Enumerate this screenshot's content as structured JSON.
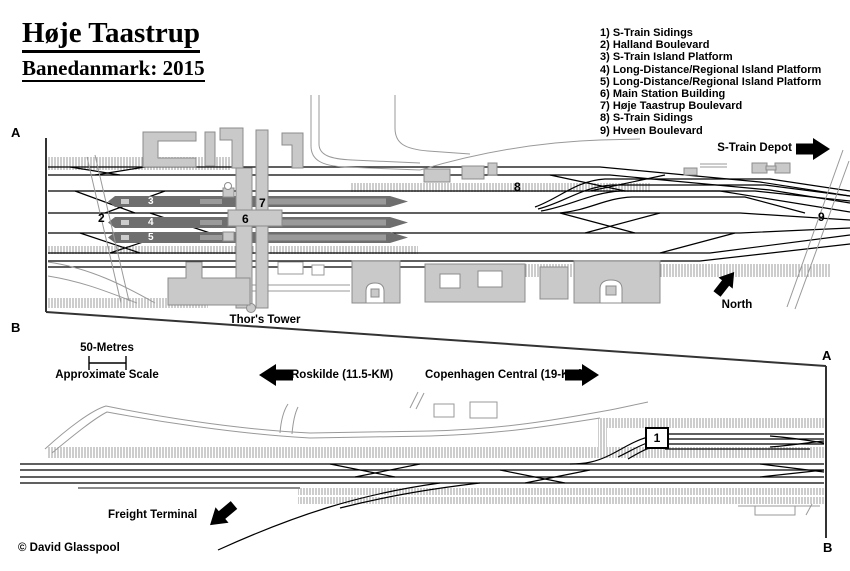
{
  "title": {
    "name": "Høje Taastrup",
    "subtitle": "Banedanmark: 2015"
  },
  "legend": {
    "items": [
      "1) S-Train Sidings",
      "2) Halland Boulevard",
      "3) S-Train Island Platform",
      "4) Long-Distance/Regional Island Platform",
      "5) Long-Distance/Regional Island Platform",
      "6) Main Station Building",
      "7) Høje Taastrup Boulevard",
      "8) S-Train Sidings",
      "9) Hveen Boulevard"
    ]
  },
  "labels": {
    "s_train_depot": "S-Train Depot",
    "north": "North",
    "thors_tower": "Thor's Tower",
    "scale_distance": "50-Metres",
    "scale_caption": "Approximate Scale",
    "roskilde": "Roskilde (11.5-KM)",
    "copenhagen_central": "Copenhagen Central (19-KM)",
    "freight_terminal": "Freight Terminal",
    "copyright": "© David Glasspool"
  },
  "markers": {
    "m1": "1",
    "m2": "2",
    "m3": "3",
    "m4": "4",
    "m5": "5",
    "m6": "6",
    "m7": "7",
    "m8": "8",
    "m9": "9"
  },
  "sections": {
    "a": "A",
    "b": "B"
  },
  "colors": {
    "background": "#ffffff",
    "track": "#000000",
    "building_fill": "#c9c9c9",
    "building_stroke": "#8c8c8c",
    "platform_fill": "#6e6e6e",
    "platform_inner": "#9a9a9a",
    "hatch": "#9b9b9b",
    "road": "#999999"
  }
}
